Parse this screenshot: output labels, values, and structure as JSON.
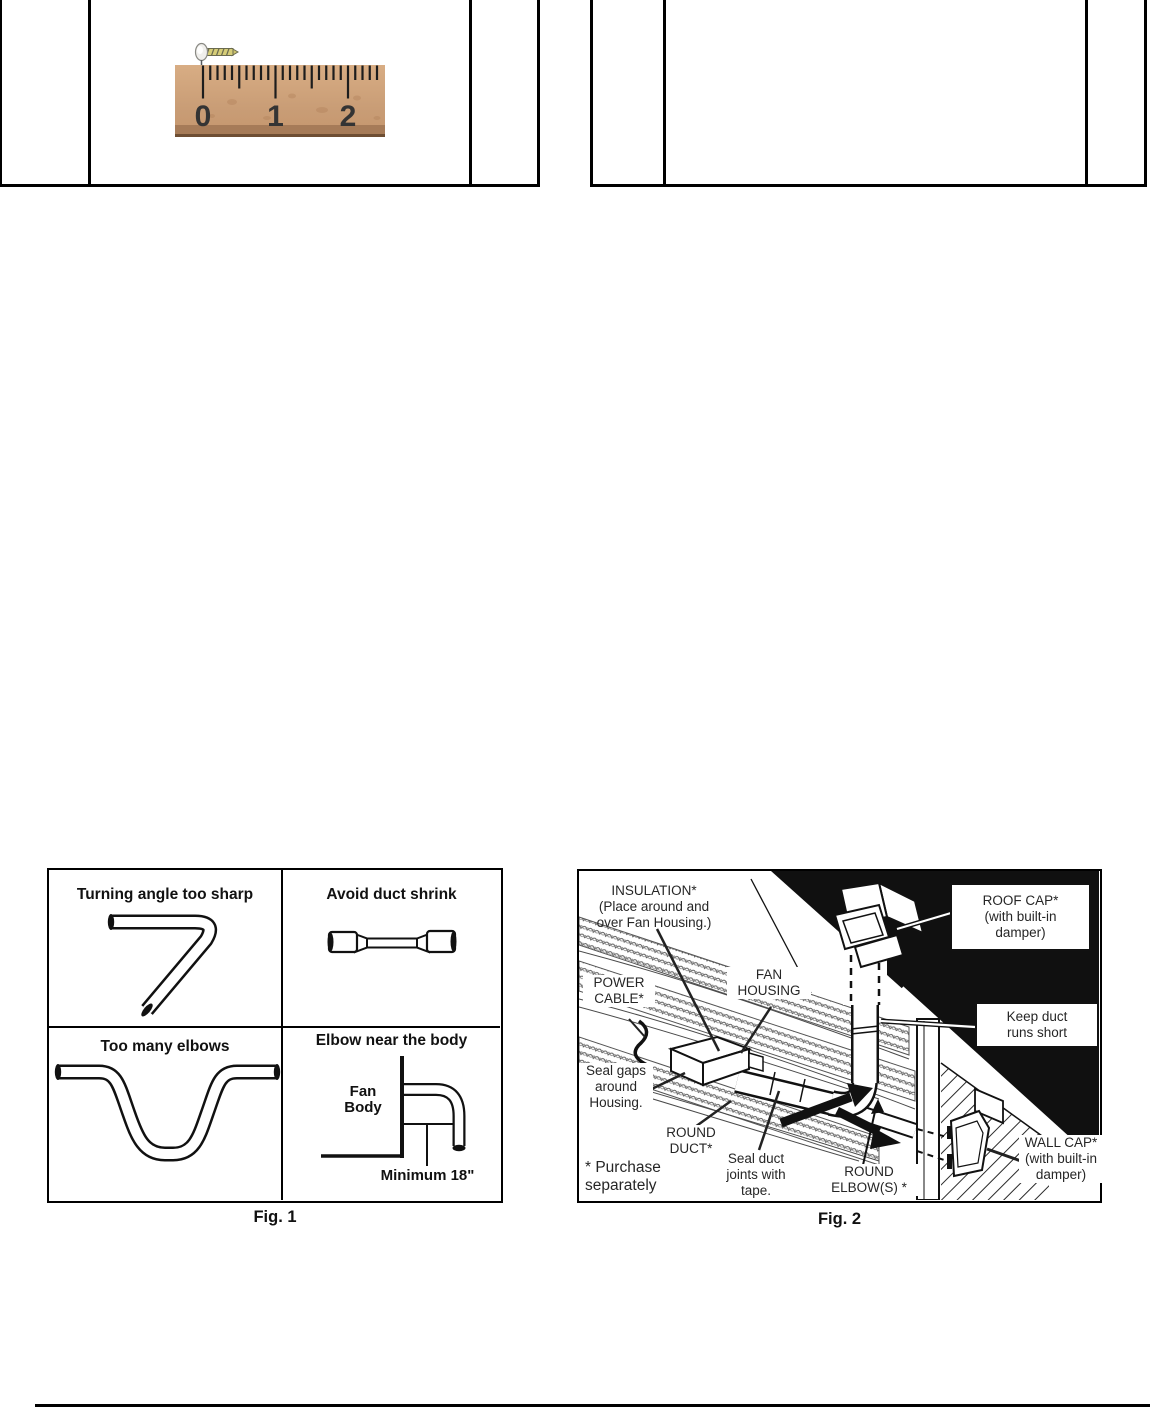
{
  "ruler": {
    "numbers": [
      "0",
      "1",
      "2"
    ]
  },
  "fig1": {
    "caption": "Fig. 1",
    "quadrants": [
      {
        "label": "Turning angle too sharp"
      },
      {
        "label": "Avoid duct shrink"
      },
      {
        "label": "Too many elbows"
      },
      {
        "label": "Elbow near the body"
      }
    ],
    "fan_body_label": "Fan\nBody",
    "minimum_label": "Minimum 18\""
  },
  "fig2": {
    "caption": "Fig. 2",
    "labels": {
      "insulation": "INSULATION*\n(Place around and\nover Fan Housing.)",
      "power_cable": "POWER\nCABLE*",
      "fan_housing": "FAN\nHOUSING",
      "roof_cap": "ROOF CAP*\n(with built-in\ndamper)",
      "keep_duct": "Keep duct\nruns short",
      "seal_gaps": "Seal gaps\naround\nHousing.",
      "round_duct": "ROUND\nDUCT*",
      "seal_joints": "Seal duct\njoints with\ntape.",
      "round_elbow": "ROUND\nELBOW(S) *",
      "wall_cap": "WALL CAP*\n(with built-in\ndamper)",
      "purchase": "* Purchase\nseparately"
    }
  },
  "colors": {
    "ink": "#111111",
    "wood_light": "#d8ad84",
    "wood_dark": "#c5966d",
    "wood_shadow": "#9b7250"
  }
}
